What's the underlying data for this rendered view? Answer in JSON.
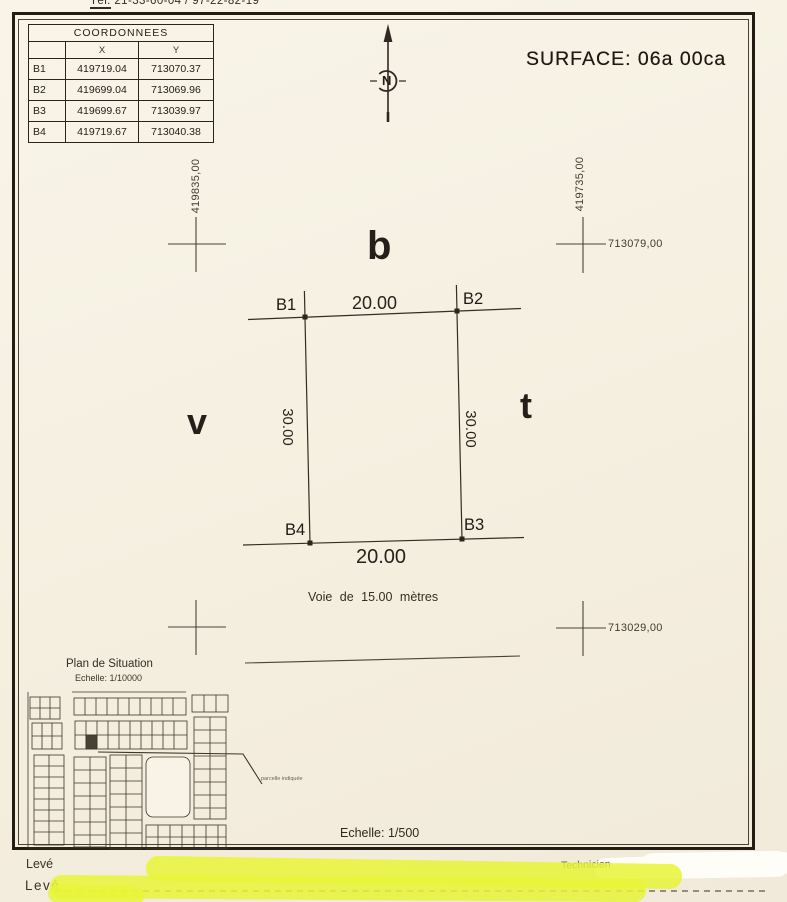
{
  "header": {
    "phone_label": "Tél:",
    "phone_number": "21-33-60-04 / 97-22-82-19",
    "surface_label": "SURFACE: 06a 00ca"
  },
  "coordinates_table": {
    "title": "COORDONNEES",
    "columns": {
      "x": "X",
      "y": "Y"
    },
    "rows": [
      {
        "point": "B1",
        "x": "419719.04",
        "y": "713070.37"
      },
      {
        "point": "B2",
        "x": "419699.04",
        "y": "713069.96"
      },
      {
        "point": "B3",
        "x": "419699.67",
        "y": "713039.97"
      },
      {
        "point": "B4",
        "x": "419719.67",
        "y": "713040.38"
      }
    ]
  },
  "north_arrow": {
    "letter": "N"
  },
  "grid": {
    "easting_left": "419835,00",
    "easting_right": "419735,00",
    "northing_top": "713079,00",
    "northing_bottom": "713029,00"
  },
  "parcel": {
    "corners": {
      "b1": "B1",
      "b2": "B2",
      "b3": "B3",
      "b4": "B4"
    },
    "dim_top": "20.00",
    "dim_bottom": "20.00",
    "dim_left": "30.00",
    "dim_right": "30.00"
  },
  "road": {
    "label": "Voie de 15.00 mètres"
  },
  "stray_letters": {
    "b": "b",
    "v": "v",
    "t": "t"
  },
  "situation_plan": {
    "title": "Plan de Situation",
    "scale": "Echelle: 1/10000",
    "note": "parcelle indiquée"
  },
  "footer": {
    "scale_main": "Echelle: 1/500",
    "leve_line1": "Levé",
    "leve_line2": "Levé",
    "technician": "Technicien"
  },
  "colors": {
    "paper": "#f6f0e1",
    "ink": "#2b241c",
    "line": "#4a433a",
    "highlighter": "#e9f52f",
    "frame": "#241c12"
  }
}
